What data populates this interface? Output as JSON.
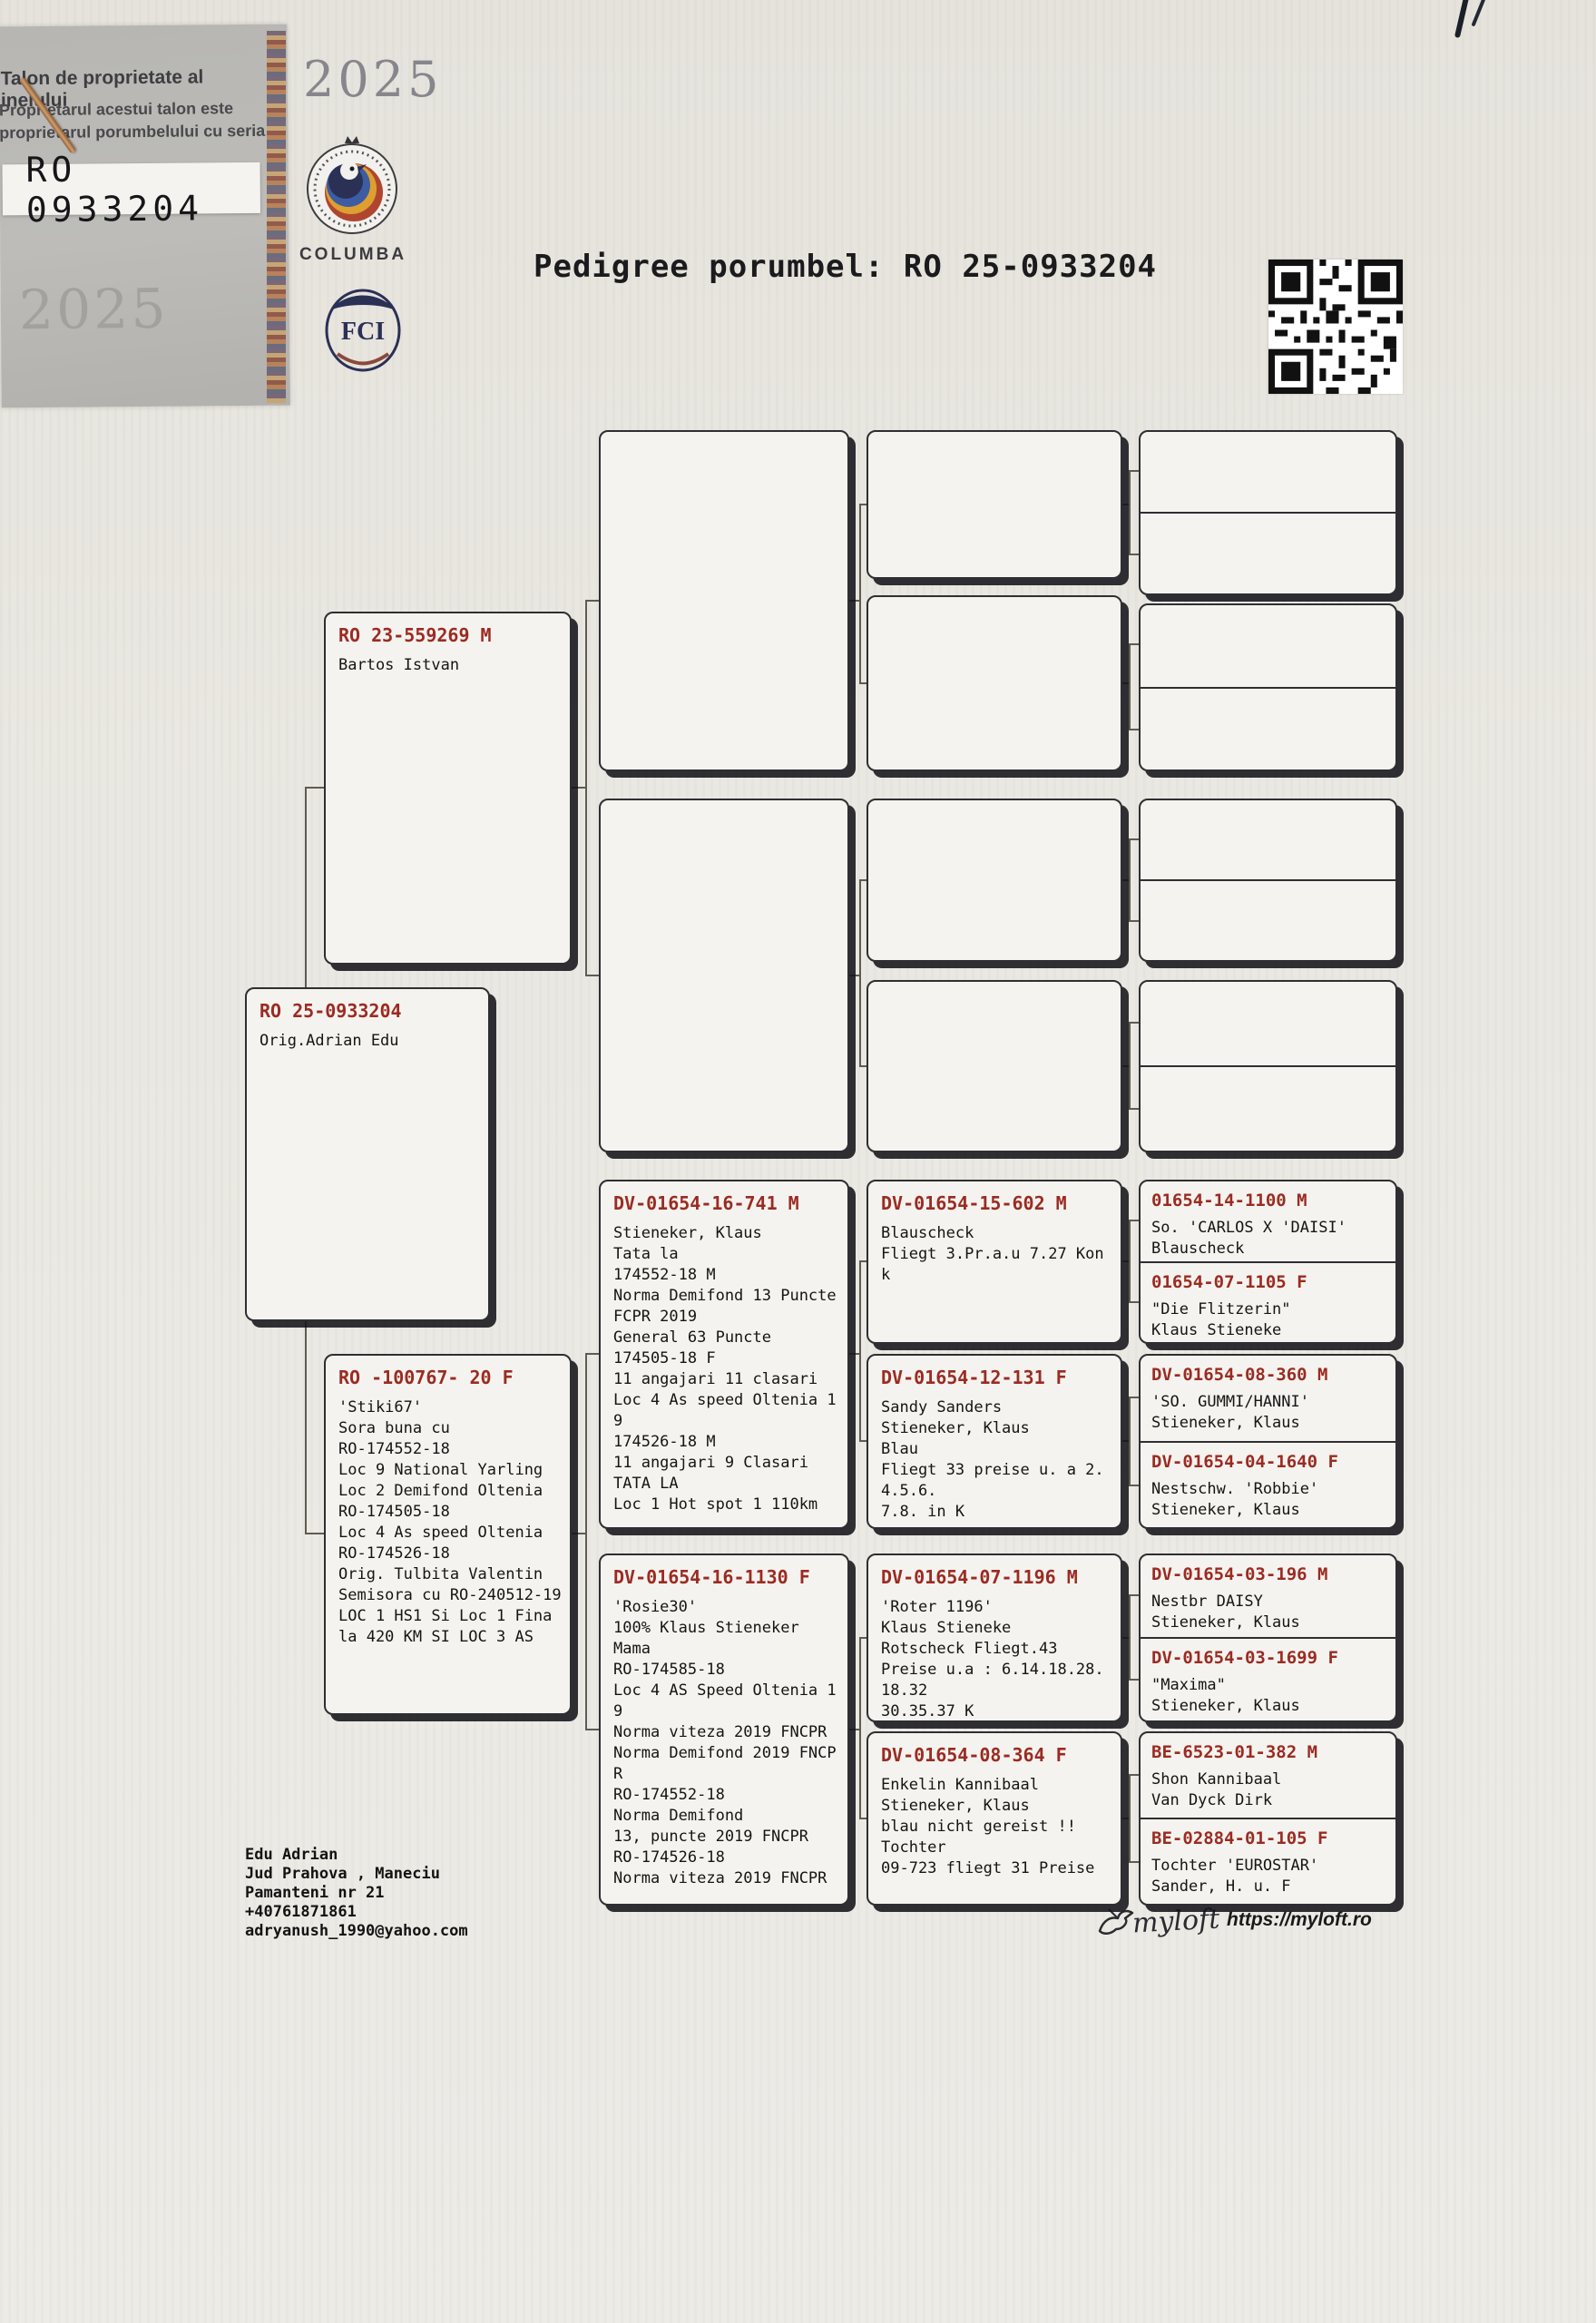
{
  "ring_talon": {
    "line1": "Talon de proprietate al inelului",
    "line2": "Proprietarul acestui talon este",
    "line3": "proprietarul porumbelului cu seria",
    "ring_number": "RO 0933204",
    "year_watermark": "2025"
  },
  "emblems": {
    "year_top": "2025",
    "columba_label": "COLUMBA",
    "fci_label": "FCI"
  },
  "title": "Pedigree porumbel: RO 25-0933204",
  "tree": {
    "subject": {
      "id": "RO 25-0933204",
      "body": [
        "Orig.Adrian Edu"
      ]
    },
    "father": {
      "id": "RO 23-559269 M",
      "body": [
        "Bartos Istvan"
      ]
    },
    "mother": {
      "id": "RO -100767- 20 F",
      "body": [
        "'Stiki67'",
        "Sora buna cu",
        "RO-174552-18",
        "Loc 9 National Yarling",
        "Loc 2 Demifond Oltenia",
        "RO-174505-18",
        "Loc 4 As speed Oltenia",
        "RO-174526-18",
        "Orig. Tulbita Valentin",
        "Semisora cu RO-240512-19",
        " LOC 1 HS1 Si Loc 1 Fina",
        "la 420 KM SI LOC 3 AS"
      ]
    },
    "mothers_father": {
      "id": "DV-01654-16-741 M",
      "body": [
        "Stieneker, Klaus",
        "Tata la",
        "174552-18 M",
        "Norma Demifond 13 Puncte",
        "FCPR 2019",
        "General 63 Puncte",
        "174505-18 F",
        "11 angajari 11 clasari",
        "Loc 4 As speed Oltenia 1",
        "9",
        "174526-18 M",
        "11 angajari 9 Clasari",
        "TATA LA",
        "Loc 1 Hot spot 1 110km"
      ]
    },
    "mothers_mother": {
      "id": "DV-01654-16-1130 F",
      "body": [
        "'Rosie30'",
        "100% Klaus Stieneker",
        "Mama",
        "RO-174585-18",
        "Loc 4 AS Speed Oltenia 1",
        "9",
        "Norma viteza 2019 FNCPR",
        "Norma Demifond 2019 FNCP",
        "R",
        "RO-174552-18",
        "Norma Demifond",
        "13, puncte 2019 FNCPR",
        "RO-174526-18",
        "Norma viteza 2019 FNCPR"
      ]
    },
    "mf_father": {
      "id": "DV-01654-15-602 M",
      "body": [
        "Blauscheck",
        "Fliegt 3.Pr.a.u 7.27 Kon",
        "k"
      ]
    },
    "mf_mother": {
      "id": "DV-01654-12-131 F",
      "body": [
        "Sandy Sanders",
        "Stieneker, Klaus",
        "Blau",
        "Fliegt 33 preise u. a 2.",
        "4.5.6.",
        "7.8. in K"
      ]
    },
    "mm_father": {
      "id": "DV-01654-07-1196 M",
      "body": [
        "'Roter 1196'",
        "Klaus Stieneke",
        "Rotscheck Fliegt.43",
        "Preise u.a : 6.14.18.28.",
        "18.32",
        "30.35.37 K"
      ]
    },
    "mm_mother": {
      "id": "DV-01654-08-364 F",
      "body": [
        "Enkelin Kannibaal",
        "Stieneker, Klaus",
        "blau nicht gereist !!",
        "Tochter",
        "09-723 fliegt 31 Preise"
      ]
    },
    "gen4": [
      {
        "id": "01654-14-1100 M",
        "body": [
          "So. 'CARLOS X 'DAISI'",
          "Blauscheck"
        ]
      },
      {
        "id": "01654-07-1105 F",
        "body": [
          "\"Die Flitzerin\"",
          "Klaus Stieneke"
        ]
      },
      {
        "id": "DV-01654-08-360 M",
        "body": [
          "'SO. GUMMI/HANNI'",
          "Stieneker, Klaus"
        ]
      },
      {
        "id": "DV-01654-04-1640 F",
        "body": [
          "Nestschw. 'Robbie'",
          "Stieneker, Klaus"
        ]
      },
      {
        "id": "DV-01654-03-196 M",
        "body": [
          "Nestbr DAISY",
          "Stieneker, Klaus"
        ]
      },
      {
        "id": "DV-01654-03-1699 F",
        "body": [
          "\"Maxima\"",
          "Stieneker, Klaus"
        ]
      },
      {
        "id": "BE-6523-01-382 M",
        "body": [
          "Shon Kannibaal",
          "Van Dyck Dirk"
        ]
      },
      {
        "id": "BE-02884-01-105 F",
        "body": [
          "Tochter 'EUROSTAR'",
          "Sander, H. u. F"
        ]
      }
    ]
  },
  "footer": {
    "owner_lines": [
      "Edu Adrian",
      "Jud Prahova , Maneciu",
      "Pamanteni nr 21",
      "+40761871861",
      "adryanush_1990@yahoo.com"
    ],
    "brand": "myloft",
    "brand_url": "https://myloft.ro"
  }
}
